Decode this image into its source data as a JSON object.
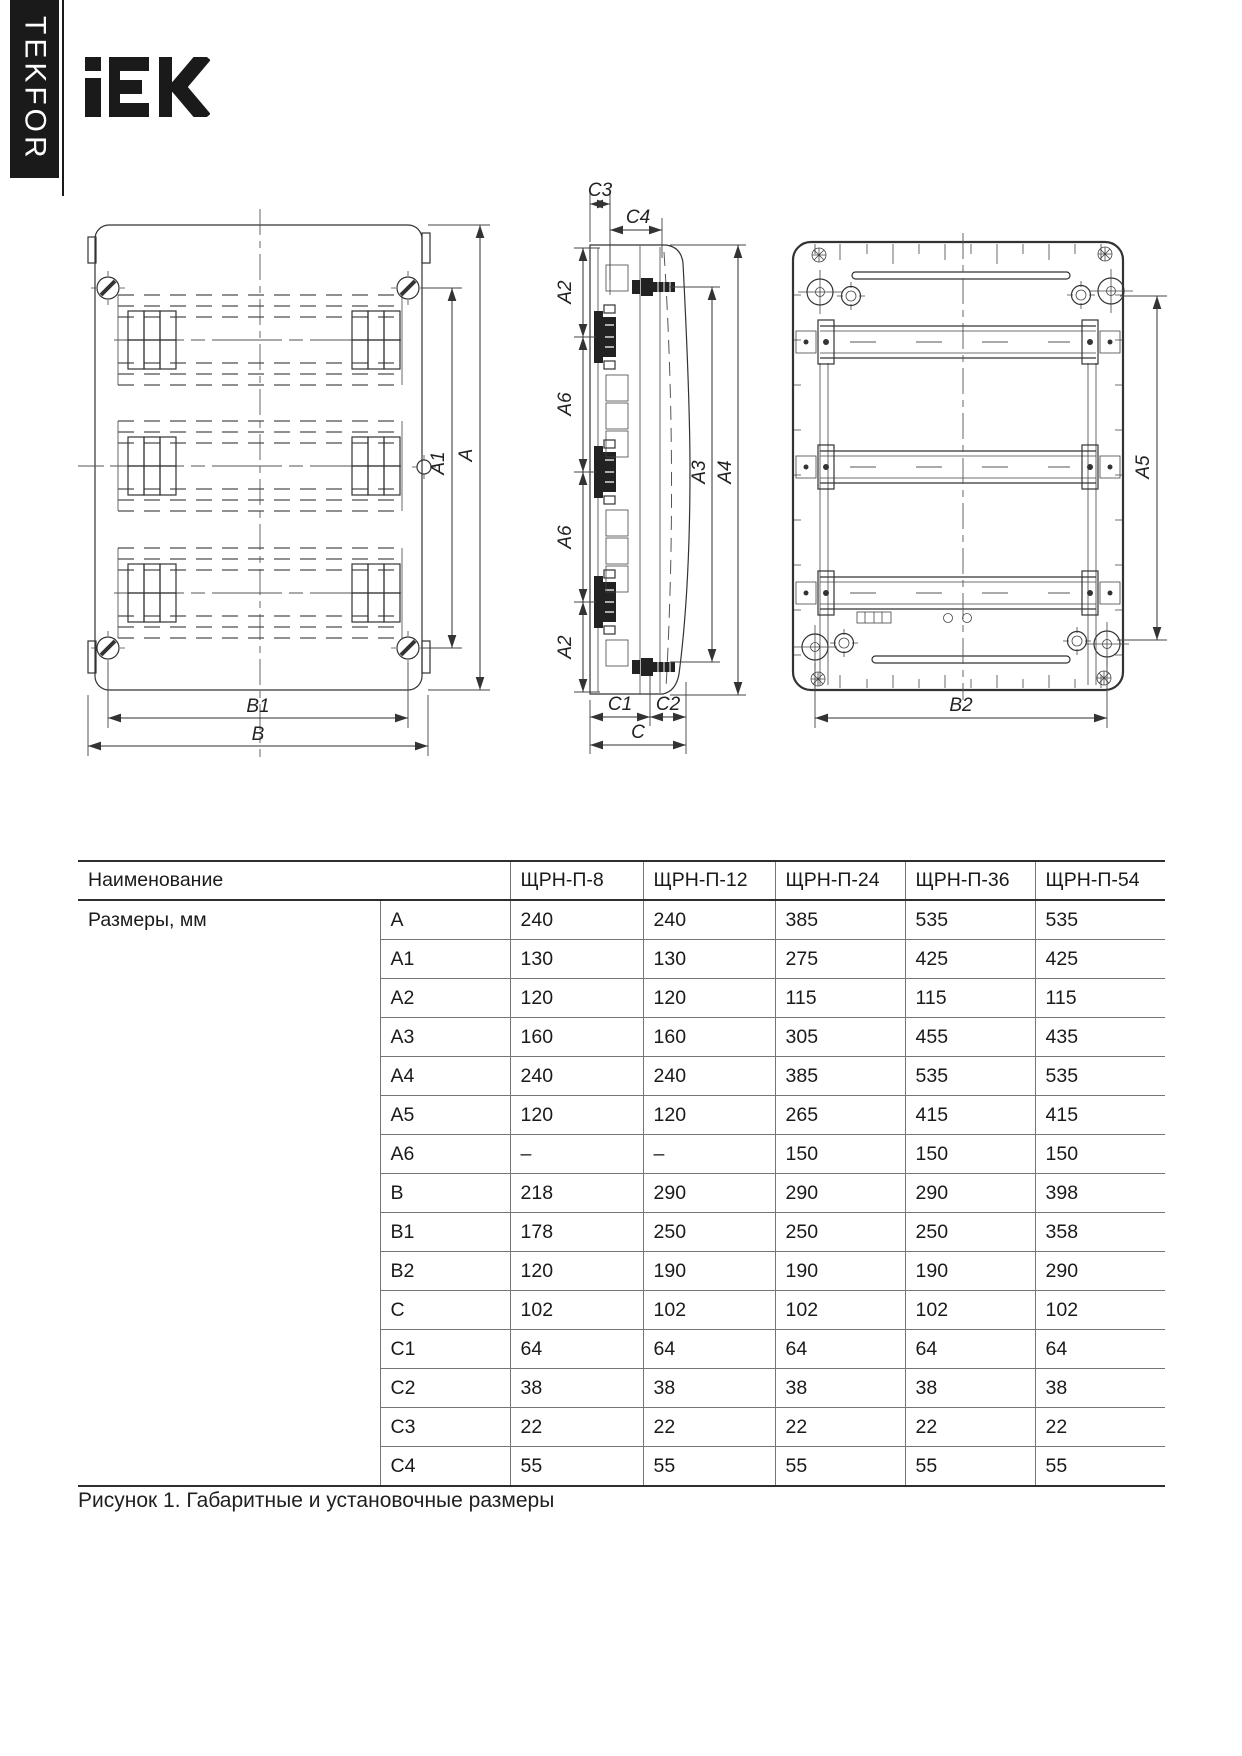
{
  "brand": {
    "tab_text": "TEKFOR"
  },
  "logo": {
    "text": "IEK"
  },
  "figure": {
    "front": {
      "a1": "A1",
      "a": "A",
      "b1": "B1",
      "b": "B"
    },
    "side": {
      "c3": "C3",
      "c4": "C4",
      "a2_top": "A2",
      "a6_upper": "A6",
      "a6_lower": "A6",
      "a2_bottom": "A2",
      "a3": "A3",
      "a4": "A4",
      "c1": "C1",
      "c2": "C2",
      "c": "C"
    },
    "back": {
      "a5": "A5",
      "b2": "B2"
    }
  },
  "table": {
    "header_name": "Наименование",
    "models": [
      "ЩРН-П-8",
      "ЩРН-П-12",
      "ЩРН-П-24",
      "ЩРН-П-36",
      "ЩРН-П-54"
    ],
    "group_label": "Размеры, мм",
    "rows": [
      {
        "dim": "A",
        "values": [
          "240",
          "240",
          "385",
          "535",
          "535"
        ]
      },
      {
        "dim": "A1",
        "values": [
          "130",
          "130",
          "275",
          "425",
          "425"
        ]
      },
      {
        "dim": "A2",
        "values": [
          "120",
          "120",
          "115",
          "115",
          "115"
        ]
      },
      {
        "dim": "A3",
        "values": [
          "160",
          "160",
          "305",
          "455",
          "435"
        ]
      },
      {
        "dim": "A4",
        "values": [
          "240",
          "240",
          "385",
          "535",
          "535"
        ]
      },
      {
        "dim": "A5",
        "values": [
          "120",
          "120",
          "265",
          "415",
          "415"
        ]
      },
      {
        "dim": "A6",
        "values": [
          "–",
          "–",
          "150",
          "150",
          "150"
        ]
      },
      {
        "dim": "B",
        "values": [
          "218",
          "290",
          "290",
          "290",
          "398"
        ]
      },
      {
        "dim": "B1",
        "values": [
          "178",
          "250",
          "250",
          "250",
          "358"
        ]
      },
      {
        "dim": "B2",
        "values": [
          "120",
          "190",
          "190",
          "190",
          "290"
        ]
      },
      {
        "dim": "C",
        "values": [
          "102",
          "102",
          "102",
          "102",
          "102"
        ]
      },
      {
        "dim": "C1",
        "values": [
          "64",
          "64",
          "64",
          "64",
          "64"
        ]
      },
      {
        "dim": "C2",
        "values": [
          "38",
          "38",
          "38",
          "38",
          "38"
        ]
      },
      {
        "dim": "C3",
        "values": [
          "22",
          "22",
          "22",
          "22",
          "22"
        ]
      },
      {
        "dim": "C4",
        "values": [
          "55",
          "55",
          "55",
          "55",
          "55"
        ]
      }
    ]
  },
  "caption": "Рисунок 1. Габаритные и установочные размеры"
}
